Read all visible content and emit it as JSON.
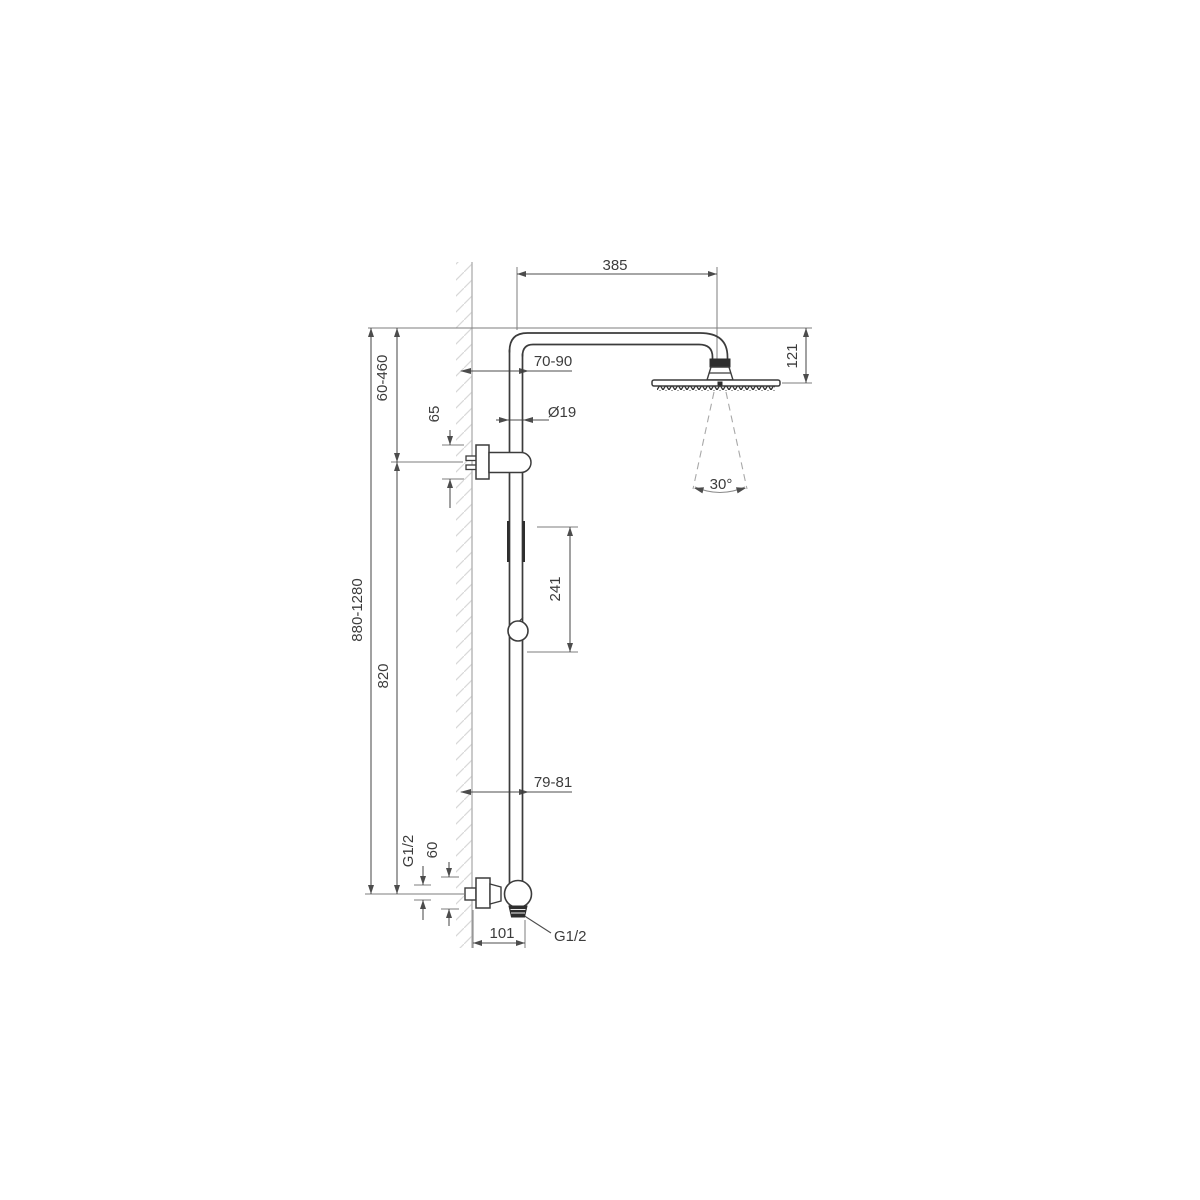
{
  "drawing": {
    "type": "technical-installation-drawing",
    "subject": "shower column with overhead rain shower head, wall bracket and exposed mixer valve",
    "units": "mm",
    "colors": {
      "background": "#ffffff",
      "contour": "#3c3c3c",
      "dimension": "#4c4c4c",
      "wall": "#b4b4b4",
      "spray": "#a8a8a8"
    },
    "labels": {
      "arm_reach": "385",
      "head_offset": "121",
      "wall_to_riser_top": "70-90",
      "upper_adjust_range": "60-460",
      "bracket_height": "65",
      "pipe_diameter": "Ø19",
      "spray_angle": "30°",
      "slider_range": "241",
      "overall_height_range": "880-1280",
      "riser_length": "820",
      "wall_to_riser_bottom": "79-81",
      "inlet_thread": "G1/2",
      "inlet_height": "60",
      "mixer_depth": "101",
      "outlet_thread": "G1/2"
    }
  }
}
